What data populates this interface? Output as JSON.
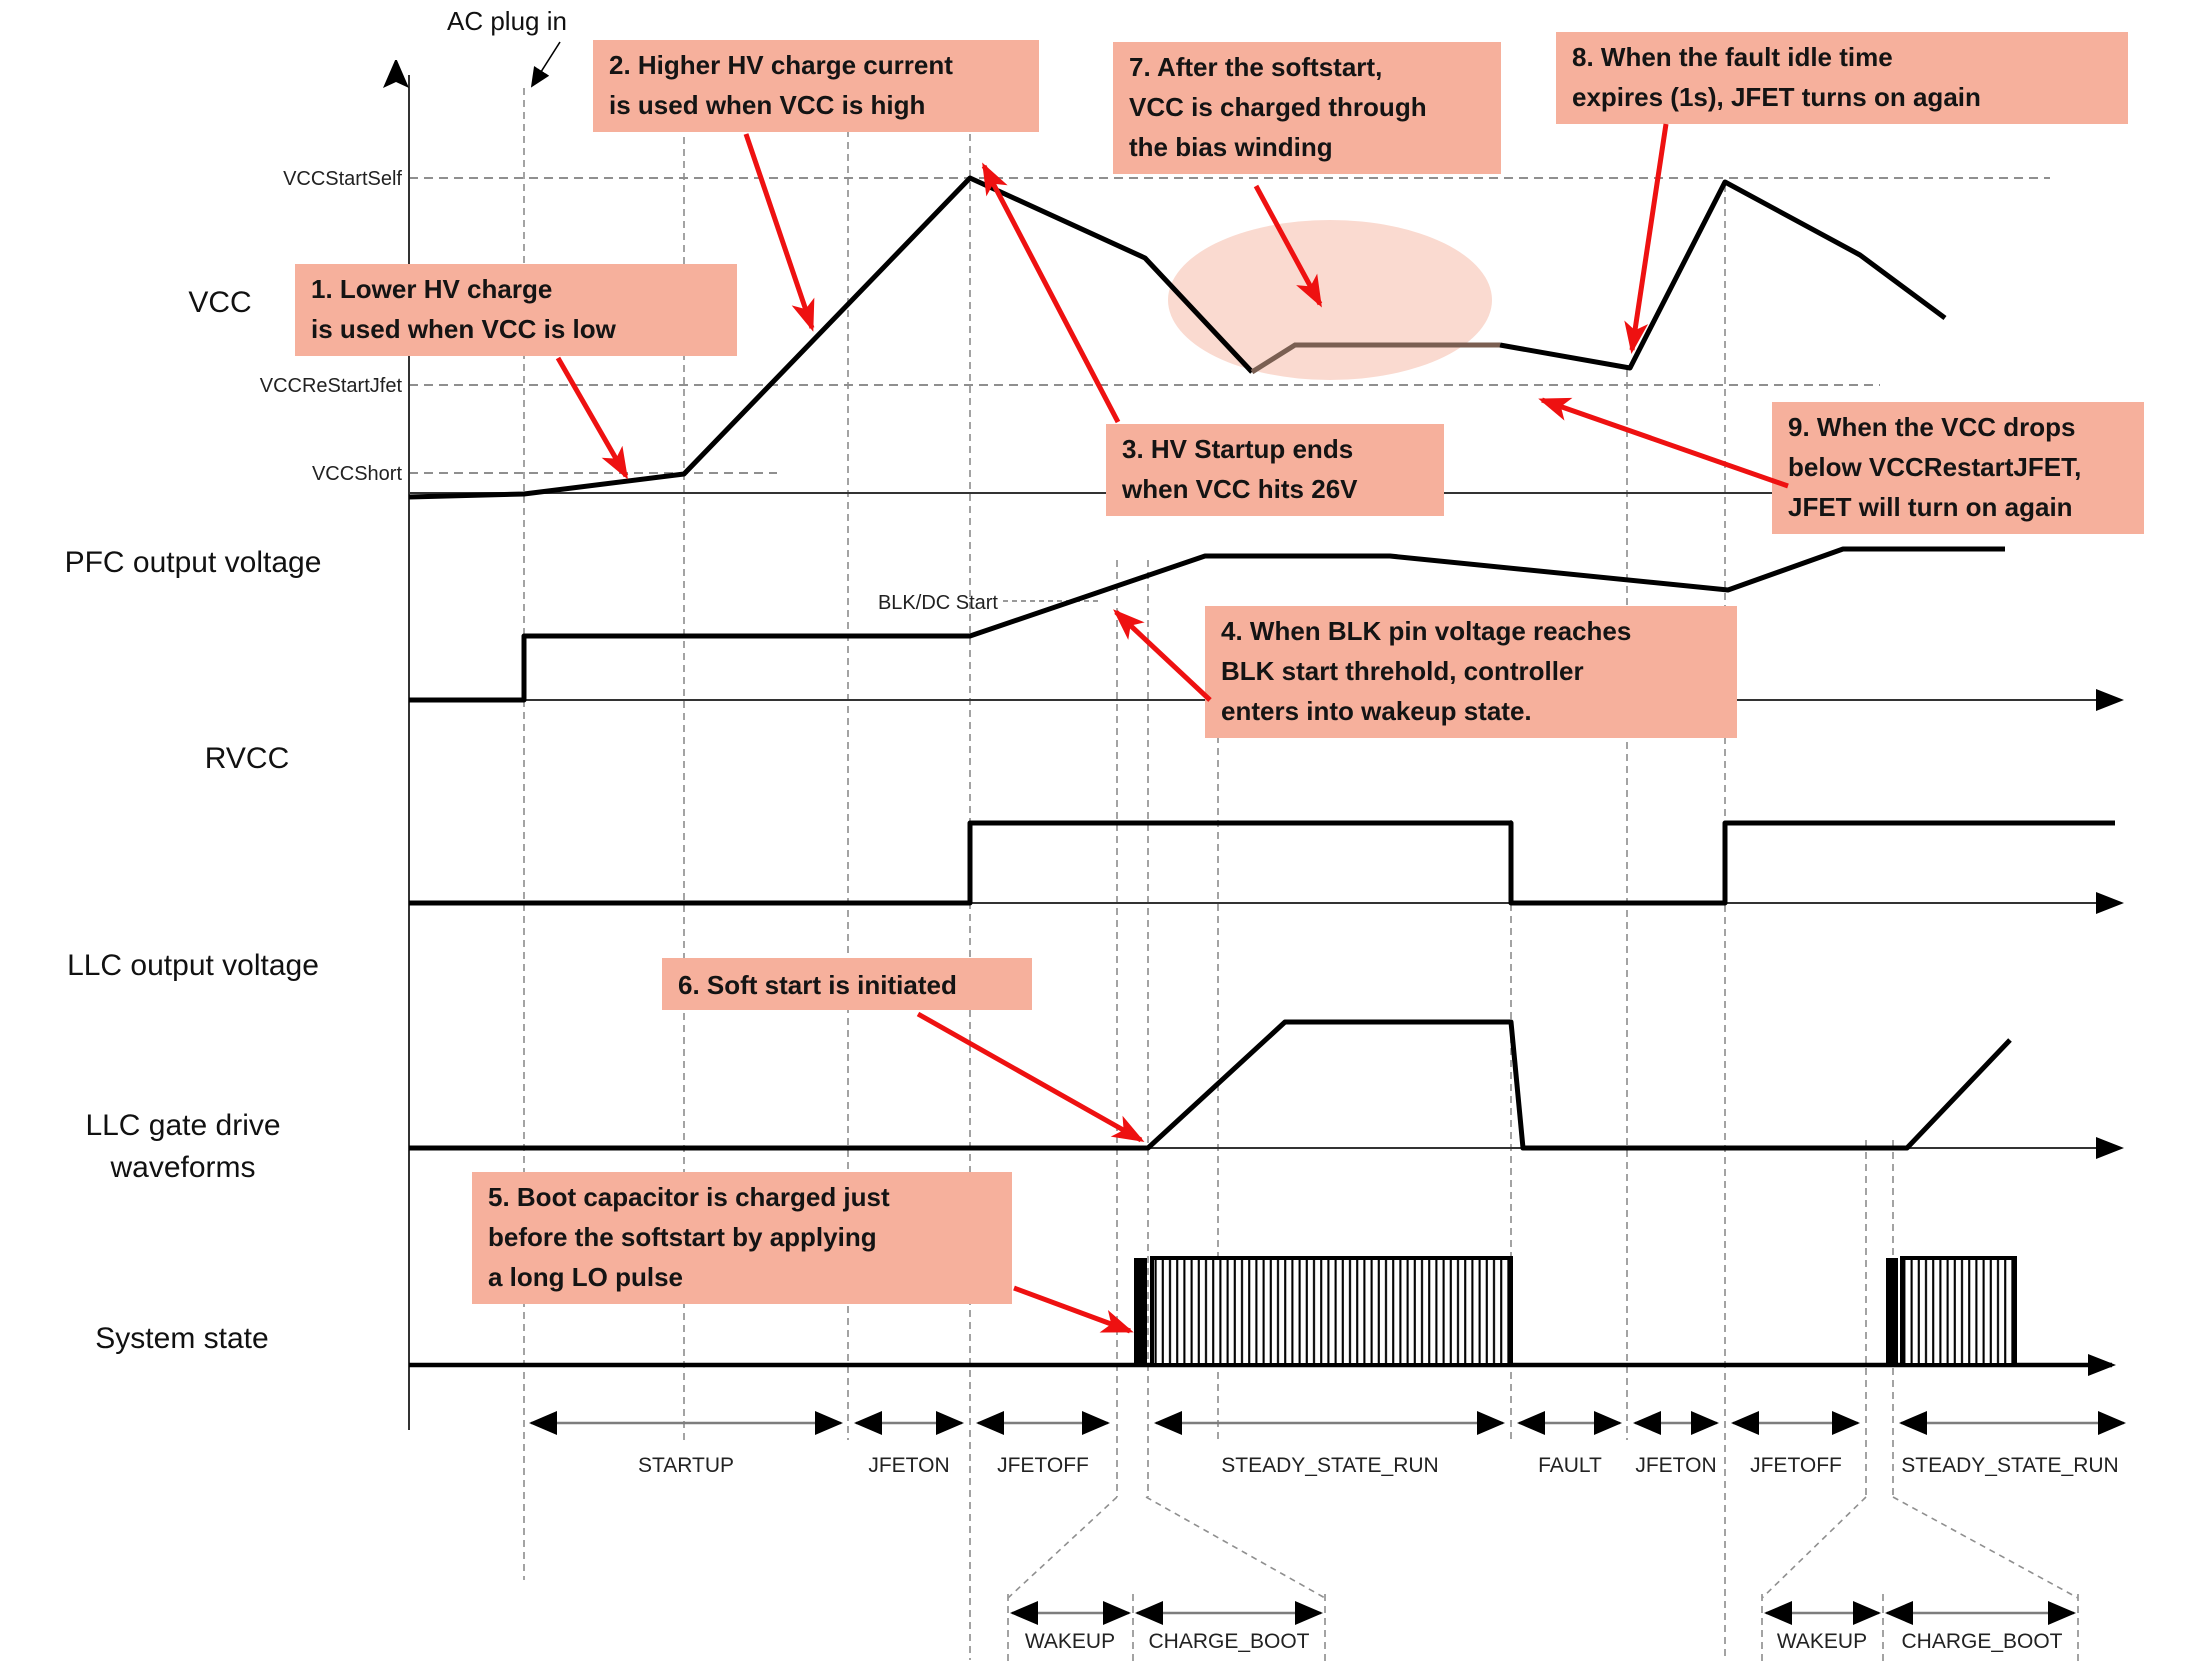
{
  "ac_plug_label": "AC plug in",
  "axis_labels": {
    "vcc_start_self": "VCCStartSelf",
    "vcc_restart_jfet": "VCCReStartJfet",
    "vcc_short": "VCCShort",
    "blk_dc_start": "BLK/DC Start"
  },
  "row_labels": {
    "vcc": "VCC",
    "pfc": "PFC output voltage",
    "rvcc": "RVCC",
    "llc_out": "LLC output voltage",
    "llc_gate_line1": "LLC gate drive",
    "llc_gate_line2": "waveforms",
    "system_state": "System state"
  },
  "annotations": [
    {
      "lines": [
        "1. Lower HV charge",
        "is used when VCC is low"
      ]
    },
    {
      "lines": [
        "2. Higher HV charge current",
        "is used when VCC is high"
      ]
    },
    {
      "lines": [
        "3. HV Startup ends",
        "when VCC hits 26V"
      ]
    },
    {
      "lines": [
        "4. When BLK pin voltage reaches",
        "BLK start threhold, controller",
        "enters into wakeup state."
      ]
    },
    {
      "lines": [
        "5. Boot capacitor is charged just",
        "before the softstart by applying",
        "a long LO pulse"
      ]
    },
    {
      "lines": [
        "6. Soft start is initiated"
      ]
    },
    {
      "lines": [
        "7. After the softstart,",
        "VCC is charged through",
        "the bias winding"
      ]
    },
    {
      "lines": [
        "8. When the fault idle time",
        "expires (1s), JFET turns on again"
      ]
    },
    {
      "lines": [
        "9. When the VCC drops",
        "below VCCRestartJFET,",
        "JFET will turn on again"
      ]
    }
  ],
  "system_states": [
    "STARTUP",
    "JFETON",
    "JFETOFF",
    "STEADY_STATE_RUN",
    "FAULT",
    "JFETON",
    "JFETOFF",
    "STEADY_STATE_RUN"
  ],
  "detail_states": [
    "WAKEUP",
    "CHARGE_BOOT",
    "WAKEUP",
    "CHARGE_BOOT"
  ],
  "colors": {
    "annotation_bg": "#f6b09c",
    "highlight_ellipse": "#f9d6cb",
    "arrow_red": "#ee1111",
    "grid_gray": "#999999",
    "waveform_black": "#000000",
    "bias_winding_segment": "#7a5f52"
  }
}
